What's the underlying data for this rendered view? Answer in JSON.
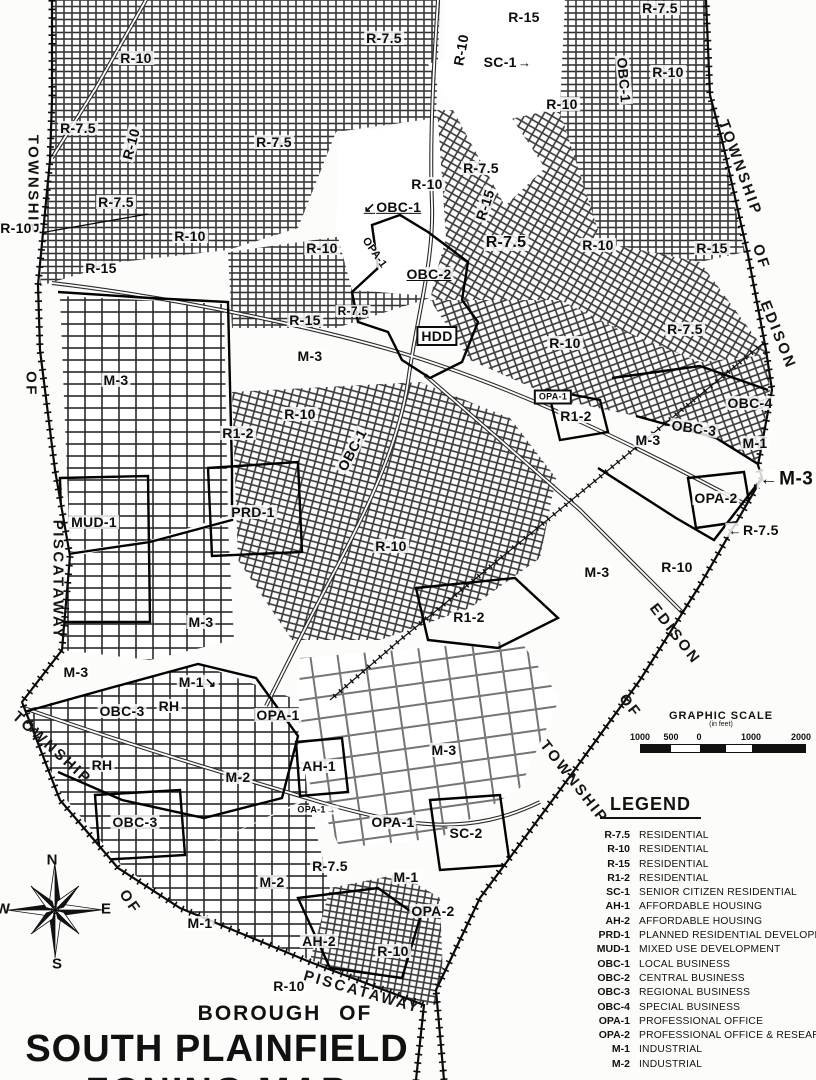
{
  "map": {
    "title_block": {
      "line1": "BOROUGH  OF",
      "line2": "SOUTH PLAINFIELD",
      "line3": "ZONING MAP"
    },
    "labels": [
      {
        "t": "R-15",
        "x": 524,
        "y": 17
      },
      {
        "t": "R-7.5",
        "x": 384,
        "y": 38
      },
      {
        "t": "R-10",
        "x": 461,
        "y": 50,
        "r": -80
      },
      {
        "t": "SC-1",
        "x": 508,
        "y": 62,
        "a": "→"
      },
      {
        "t": "R-7.5",
        "x": 660,
        "y": 8
      },
      {
        "t": "R-10",
        "x": 668,
        "y": 72
      },
      {
        "t": "OBC-1",
        "x": 624,
        "y": 80,
        "r": 85
      },
      {
        "t": "R-10",
        "x": 562,
        "y": 104
      },
      {
        "t": "R-10",
        "x": 136,
        "y": 58
      },
      {
        "t": "R-7.5",
        "x": 78,
        "y": 128
      },
      {
        "t": "R-10",
        "x": 131,
        "y": 144,
        "r": -75
      },
      {
        "t": "R-7.5",
        "x": 274,
        "y": 142
      },
      {
        "t": "R-7.5",
        "x": 481,
        "y": 168
      },
      {
        "t": "R-10",
        "x": 427,
        "y": 184
      },
      {
        "t": "R-15",
        "x": 485,
        "y": 205,
        "r": -72
      },
      {
        "t": "OBC-1",
        "x": 392,
        "y": 207,
        "c": "ul",
        "ap": "↙"
      },
      {
        "t": "TOWNSHIP",
        "x": 33,
        "y": 185,
        "r": 90,
        "c": "tw"
      },
      {
        "t": "R-10",
        "x": 16,
        "y": 228
      },
      {
        "t": "R-7.5",
        "x": 116,
        "y": 202
      },
      {
        "t": "R-10",
        "x": 190,
        "y": 236
      },
      {
        "t": "R-7.5",
        "x": 506,
        "y": 243,
        "s": 16
      },
      {
        "t": "R-10",
        "x": 322,
        "y": 248
      },
      {
        "t": "OPA-1",
        "x": 374,
        "y": 253,
        "r": 55,
        "s": 11
      },
      {
        "t": "R-10",
        "x": 598,
        "y": 245
      },
      {
        "t": "R-15",
        "x": 712,
        "y": 248
      },
      {
        "t": "TOWNSHIP",
        "x": 740,
        "y": 168,
        "r": 70,
        "c": "tw"
      },
      {
        "t": "OF",
        "x": 761,
        "y": 257,
        "r": 72,
        "c": "tw"
      },
      {
        "t": "EDISON",
        "x": 778,
        "y": 335,
        "r": 68,
        "c": "tw"
      },
      {
        "t": "R-15",
        "x": 101,
        "y": 268
      },
      {
        "t": "OBC-2",
        "x": 429,
        "y": 274,
        "c": "ul"
      },
      {
        "t": "R-7.5",
        "x": 353,
        "y": 311,
        "s": 12
      },
      {
        "t": "R-15",
        "x": 305,
        "y": 320
      },
      {
        "t": "HDD",
        "x": 437,
        "y": 336,
        "c": "box"
      },
      {
        "t": "M-3",
        "x": 310,
        "y": 356
      },
      {
        "t": "M-3",
        "x": 116,
        "y": 380
      },
      {
        "t": "OF",
        "x": 31,
        "y": 384,
        "r": 90,
        "c": "tw"
      },
      {
        "t": "R-10",
        "x": 300,
        "y": 414
      },
      {
        "t": "R1-2",
        "x": 238,
        "y": 433
      },
      {
        "t": "OBC-1",
        "x": 352,
        "y": 450,
        "r": -62
      },
      {
        "t": "R-7.5",
        "x": 685,
        "y": 329
      },
      {
        "t": "R-10",
        "x": 565,
        "y": 343
      },
      {
        "t": "OPA-1",
        "x": 553,
        "y": 397,
        "c": "box",
        "s": 9
      },
      {
        "t": "R1-2",
        "x": 576,
        "y": 416
      },
      {
        "t": "OBC-4",
        "x": 750,
        "y": 403
      },
      {
        "t": "OBC-3",
        "x": 694,
        "y": 428,
        "r": 8
      },
      {
        "t": "M-3",
        "x": 648,
        "y": 440
      },
      {
        "t": "M-1",
        "x": 755,
        "y": 443
      },
      {
        "t": "M-3",
        "x": 786,
        "y": 479,
        "c": "big",
        "ap": "←"
      },
      {
        "t": "OPA-2",
        "x": 716,
        "y": 498
      },
      {
        "t": "R-7.5",
        "x": 753,
        "y": 530,
        "ap": "←"
      },
      {
        "t": "MUD-1",
        "x": 94,
        "y": 522
      },
      {
        "t": "PRD-1",
        "x": 253,
        "y": 512
      },
      {
        "t": "PISCATAWAY",
        "x": 58,
        "y": 580,
        "r": 90,
        "c": "tw"
      },
      {
        "t": "R-10",
        "x": 391,
        "y": 546
      },
      {
        "t": "M-3",
        "x": 597,
        "y": 572
      },
      {
        "t": "R-10",
        "x": 677,
        "y": 567
      },
      {
        "t": "R1-2",
        "x": 469,
        "y": 617
      },
      {
        "t": "M-3",
        "x": 201,
        "y": 622
      },
      {
        "t": "EDISON",
        "x": 675,
        "y": 634,
        "r": 52,
        "c": "tw"
      },
      {
        "t": "OF",
        "x": 630,
        "y": 706,
        "r": 52,
        "c": "tw"
      },
      {
        "t": "TOWNSHIP",
        "x": 574,
        "y": 782,
        "r": 52,
        "c": "tw"
      },
      {
        "t": "M-3",
        "x": 76,
        "y": 672
      },
      {
        "t": "M-1",
        "x": 198,
        "y": 682,
        "a": "↘"
      },
      {
        "t": "RH",
        "x": 169,
        "y": 706
      },
      {
        "t": "OBC-3",
        "x": 122,
        "y": 711
      },
      {
        "t": "OPA-1",
        "x": 278,
        "y": 715
      },
      {
        "t": "M-3",
        "x": 444,
        "y": 750
      },
      {
        "t": "TOWNSHIP",
        "x": 52,
        "y": 748,
        "r": 42,
        "c": "tw"
      },
      {
        "t": "RH",
        "x": 102,
        "y": 765
      },
      {
        "t": "M-2",
        "x": 238,
        "y": 777
      },
      {
        "t": "AH-1",
        "x": 319,
        "y": 766
      },
      {
        "t": "OBC-3",
        "x": 135,
        "y": 822
      },
      {
        "t": "OPA-1",
        "x": 317,
        "y": 810,
        "s": 9,
        "a": "→"
      },
      {
        "t": "OPA-1",
        "x": 393,
        "y": 822
      },
      {
        "t": "SC-2",
        "x": 466,
        "y": 833
      },
      {
        "t": "R-7.5",
        "x": 330,
        "y": 866
      },
      {
        "t": "M-2",
        "x": 272,
        "y": 882
      },
      {
        "t": "M-1",
        "x": 406,
        "y": 877
      },
      {
        "t": "OPA-2",
        "x": 433,
        "y": 911
      },
      {
        "t": "OF",
        "x": 130,
        "y": 902,
        "r": 55,
        "c": "tw"
      },
      {
        "t": "M-1",
        "x": 200,
        "y": 923
      },
      {
        "t": "AH-2",
        "x": 319,
        "y": 941
      },
      {
        "t": "R-10",
        "x": 393,
        "y": 951
      },
      {
        "t": "R-10",
        "x": 289,
        "y": 986
      },
      {
        "t": "PISCATAWAY",
        "x": 362,
        "y": 992,
        "r": 16,
        "c": "tw"
      }
    ]
  },
  "legend": {
    "title": "LEGEND",
    "entries": [
      {
        "code": "R-7.5",
        "desc": "RESIDENTIAL"
      },
      {
        "code": "R-10",
        "desc": "RESIDENTIAL"
      },
      {
        "code": "R-15",
        "desc": "RESIDENTIAL"
      },
      {
        "code": "R1-2",
        "desc": "RESIDENTIAL"
      },
      {
        "code": "SC-1",
        "desc": "SENIOR CITIZEN RESIDENTIAL"
      },
      {
        "code": "AH-1",
        "desc": "AFFORDABLE HOUSING"
      },
      {
        "code": "AH-2",
        "desc": "AFFORDABLE HOUSING"
      },
      {
        "code": "PRD-1",
        "desc": "PLANNED RESIDENTIAL DEVELOPMENT"
      },
      {
        "code": "MUD-1",
        "desc": "MIXED USE DEVELOPMENT"
      },
      {
        "code": "OBC-1",
        "desc": "LOCAL BUSINESS"
      },
      {
        "code": "OBC-2",
        "desc": "CENTRAL BUSINESS"
      },
      {
        "code": "OBC-3",
        "desc": "REGIONAL BUSINESS"
      },
      {
        "code": "OBC-4",
        "desc": "SPECIAL BUSINESS"
      },
      {
        "code": "OPA-1",
        "desc": "PROFESSIONAL OFFICE"
      },
      {
        "code": "OPA-2",
        "desc": "PROFESSIONAL OFFICE & RESEARCH"
      },
      {
        "code": "M-1",
        "desc": "INDUSTRIAL"
      },
      {
        "code": "M-2",
        "desc": "INDUSTRIAL"
      }
    ]
  },
  "scale": {
    "title": "GRAPHIC  SCALE",
    "subtitle": "(in feet)",
    "ticks": [
      {
        "label": "1000",
        "x": 640
      },
      {
        "label": "500",
        "x": 671
      },
      {
        "label": "0",
        "x": 699
      },
      {
        "label": "1000",
        "x": 751
      },
      {
        "label": "2000",
        "x": 801
      }
    ]
  },
  "compass": {
    "n": "N",
    "e": "E",
    "s": "S",
    "w": "W"
  },
  "colors": {
    "ink": "#111111",
    "paper": "#fcfcfa"
  }
}
